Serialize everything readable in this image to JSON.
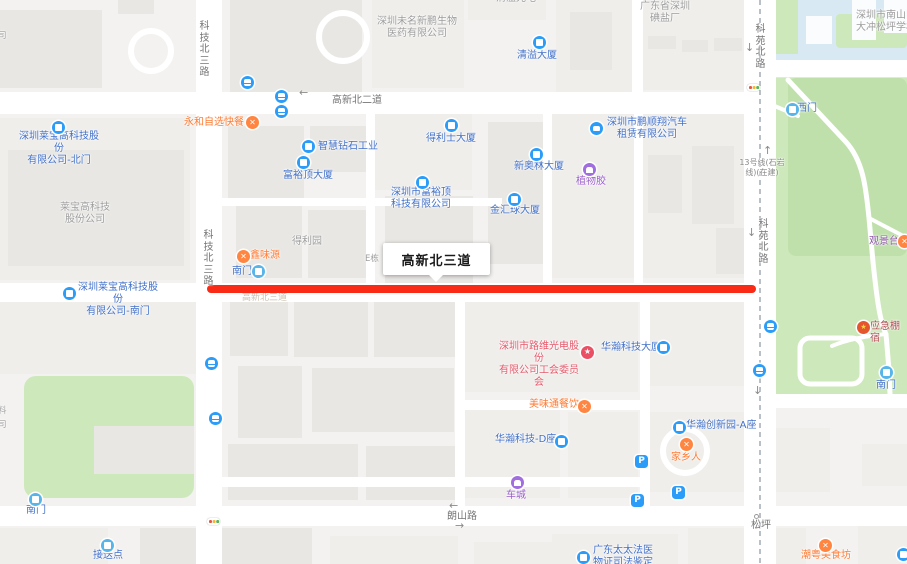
{
  "map": {
    "size": {
      "w": 907,
      "h": 564
    },
    "colors": {
      "base": "#f3f2f0",
      "building": "#e8e7e4",
      "building_light": "#efeeeb",
      "road": "#ffffff",
      "park_green": "#cde8ba",
      "park_green_dark": "#bfe0ab",
      "school_blue": "#d9e9f4",
      "highlight_red": "#fa2b16",
      "poi_blue_text": "#4170c9",
      "poi_icon_blue": "#2b9df8",
      "gate_icon_blue": "#58b5e9",
      "food_orange": "#ff7a33",
      "purple": "#9a5ecb",
      "union_red": "#e4586a",
      "emergency_red": "#b04a50",
      "scenic_purple": "#8d55a6",
      "gray_label": "#9c9c9c",
      "road_label": "#757575",
      "metro_dash": "#9aa2ac"
    },
    "callout": {
      "text": "高新北三道",
      "x": 383,
      "y": 243,
      "w": 107,
      "h": 32
    },
    "highlight": {
      "x": 207,
      "y": 285,
      "w": 549,
      "h": 8,
      "color": "#fa2b16"
    },
    "school": {
      "x": 768,
      "y": 0,
      "w": 139,
      "h": 80
    },
    "greens": [
      {
        "x": 763,
        "y": 78,
        "w": 144,
        "h": 330,
        "r": 0
      },
      {
        "x": 788,
        "y": 78,
        "w": 119,
        "h": 178,
        "r": 8,
        "shade": "dark"
      },
      {
        "x": 24,
        "y": 376,
        "w": 170,
        "h": 122,
        "r": 12
      },
      {
        "x": 772,
        "y": 0,
        "w": 26,
        "h": 54,
        "r": 0
      },
      {
        "x": 836,
        "y": 14,
        "w": 71,
        "h": 34,
        "r": 4
      }
    ],
    "white_buildings": [
      {
        "x": 852,
        "y": 0,
        "w": 24,
        "h": 40
      },
      {
        "x": 884,
        "y": 0,
        "w": 23,
        "h": 33
      },
      {
        "x": 806,
        "y": 16,
        "w": 26,
        "h": 28
      }
    ],
    "buildings": [
      {
        "x": 0,
        "y": 10,
        "w": 102,
        "h": 78
      },
      {
        "x": 118,
        "y": 0,
        "w": 36,
        "h": 14
      },
      {
        "x": 230,
        "y": 0,
        "w": 132,
        "h": 92
      },
      {
        "x": 372,
        "y": 0,
        "w": 92,
        "h": 88,
        "light": true
      },
      {
        "x": 468,
        "y": 0,
        "w": 78,
        "h": 20,
        "light": true
      },
      {
        "x": 556,
        "y": 0,
        "w": 76,
        "h": 92,
        "light": true
      },
      {
        "x": 570,
        "y": 12,
        "w": 42,
        "h": 58
      },
      {
        "x": 640,
        "y": 0,
        "w": 118,
        "h": 90,
        "light": true
      },
      {
        "x": 648,
        "y": 36,
        "w": 28,
        "h": 13
      },
      {
        "x": 682,
        "y": 40,
        "w": 26,
        "h": 12
      },
      {
        "x": 714,
        "y": 38,
        "w": 28,
        "h": 13
      },
      {
        "x": 0,
        "y": 118,
        "w": 190,
        "h": 162,
        "light": true
      },
      {
        "x": 8,
        "y": 150,
        "w": 176,
        "h": 116
      },
      {
        "x": 228,
        "y": 126,
        "w": 76,
        "h": 72
      },
      {
        "x": 310,
        "y": 126,
        "w": 56,
        "h": 46
      },
      {
        "x": 372,
        "y": 112,
        "w": 100,
        "h": 78,
        "light": true
      },
      {
        "x": 385,
        "y": 196,
        "w": 88,
        "h": 118
      },
      {
        "x": 236,
        "y": 206,
        "w": 66,
        "h": 72
      },
      {
        "x": 308,
        "y": 210,
        "w": 58,
        "h": 68
      },
      {
        "x": 488,
        "y": 122,
        "w": 58,
        "h": 142
      },
      {
        "x": 552,
        "y": 110,
        "w": 82,
        "h": 168,
        "light": true
      },
      {
        "x": 640,
        "y": 110,
        "w": 118,
        "h": 168,
        "light": true
      },
      {
        "x": 648,
        "y": 155,
        "w": 34,
        "h": 58
      },
      {
        "x": 692,
        "y": 146,
        "w": 42,
        "h": 78
      },
      {
        "x": 716,
        "y": 228,
        "w": 42,
        "h": 46
      },
      {
        "x": 0,
        "y": 302,
        "w": 196,
        "h": 72,
        "light": true
      },
      {
        "x": 94,
        "y": 426,
        "w": 100,
        "h": 48
      },
      {
        "x": 230,
        "y": 302,
        "w": 58,
        "h": 54
      },
      {
        "x": 294,
        "y": 300,
        "w": 74,
        "h": 57
      },
      {
        "x": 374,
        "y": 300,
        "w": 82,
        "h": 57
      },
      {
        "x": 238,
        "y": 366,
        "w": 64,
        "h": 72
      },
      {
        "x": 312,
        "y": 368,
        "w": 142,
        "h": 64
      },
      {
        "x": 228,
        "y": 444,
        "w": 130,
        "h": 56
      },
      {
        "x": 366,
        "y": 446,
        "w": 90,
        "h": 54
      },
      {
        "x": 462,
        "y": 298,
        "w": 176,
        "h": 94,
        "light": true
      },
      {
        "x": 646,
        "y": 300,
        "w": 112,
        "h": 86,
        "light": true
      },
      {
        "x": 462,
        "y": 410,
        "w": 98,
        "h": 88,
        "light": true
      },
      {
        "x": 568,
        "y": 412,
        "w": 70,
        "h": 86,
        "light": true
      },
      {
        "x": 648,
        "y": 412,
        "w": 110,
        "h": 80,
        "light": true
      },
      {
        "x": 772,
        "y": 428,
        "w": 58,
        "h": 64,
        "light": true
      },
      {
        "x": 862,
        "y": 444,
        "w": 45,
        "h": 42,
        "light": true
      },
      {
        "x": 0,
        "y": 528,
        "w": 108,
        "h": 36,
        "light": true
      },
      {
        "x": 140,
        "y": 528,
        "w": 172,
        "h": 36
      },
      {
        "x": 330,
        "y": 536,
        "w": 128,
        "h": 28,
        "light": true
      },
      {
        "x": 474,
        "y": 542,
        "w": 88,
        "h": 22,
        "light": true
      },
      {
        "x": 552,
        "y": 534,
        "w": 126,
        "h": 30,
        "light": true
      },
      {
        "x": 688,
        "y": 528,
        "w": 118,
        "h": 36,
        "light": true
      },
      {
        "x": 858,
        "y": 524,
        "w": 49,
        "h": 40,
        "light": true
      }
    ],
    "rings": [
      {
        "x": 128,
        "y": 28,
        "d": 46
      },
      {
        "x": 316,
        "y": 10,
        "d": 54
      },
      {
        "x": 660,
        "y": 426,
        "d": 50
      }
    ],
    "roads": [
      {
        "x": 196,
        "y": 0,
        "w": 26,
        "h": 564
      },
      {
        "x": 744,
        "y": 0,
        "w": 32,
        "h": 564
      },
      {
        "x": 0,
        "y": 92,
        "w": 748,
        "h": 22
      },
      {
        "x": 768,
        "y": 60,
        "w": 139,
        "h": 17
      },
      {
        "x": 744,
        "y": 60,
        "w": 32,
        "h": 54
      },
      {
        "x": 0,
        "y": 283,
        "w": 748,
        "h": 19
      },
      {
        "x": 0,
        "y": 506,
        "w": 907,
        "h": 20
      },
      {
        "x": 744,
        "y": 394,
        "w": 163,
        "h": 14
      },
      {
        "x": 366,
        "y": 110,
        "w": 9,
        "h": 173
      },
      {
        "x": 543,
        "y": 110,
        "w": 9,
        "h": 173
      },
      {
        "x": 634,
        "y": 110,
        "w": 9,
        "h": 173
      },
      {
        "x": 632,
        "y": 0,
        "w": 11,
        "h": 95
      },
      {
        "x": 222,
        "y": 198,
        "w": 280,
        "h": 8
      },
      {
        "x": 455,
        "y": 301,
        "w": 10,
        "h": 205
      },
      {
        "x": 640,
        "y": 301,
        "w": 10,
        "h": 205
      },
      {
        "x": 220,
        "y": 477,
        "w": 424,
        "h": 10
      },
      {
        "x": 455,
        "y": 400,
        "w": 195,
        "h": 10
      }
    ],
    "park_paths": [
      {
        "d": "M788,80 L846,142 C864,162 866,190 869,218 L873,262 C877,300 880,322 886,334 L889,370 L890,394",
        "w": 5
      },
      {
        "d": "M869,218 C884,226 896,232 907,238",
        "w": 4
      },
      {
        "d": "M886,334 C866,336 846,340 832,346",
        "w": 4
      },
      {
        "d": "M770,104 L798,116",
        "w": 4
      }
    ],
    "park_loop": {
      "x": 800,
      "y": 338,
      "w": 62,
      "h": 46,
      "r": 10,
      "stroke": 5
    },
    "metro_line": {
      "x": 760,
      "dash": "5 4",
      "color": "#9aa2ac"
    },
    "labels": [
      {
        "t": "清溢光电",
        "x": 496,
        "y": -7,
        "cls": "area"
      },
      {
        "t": "深圳未名新鹏生物\n医药有限公司",
        "x": 374,
        "y": 16,
        "w": 86,
        "cls": "area"
      },
      {
        "t": "广东省深圳\n碘盐厂",
        "x": 634,
        "y": 1,
        "w": 62,
        "cls": "area"
      },
      {
        "t": "深圳市南山区\n大冲松坪学校",
        "x": 851,
        "y": 10,
        "w": 70,
        "cls": "area"
      },
      {
        "t": "司",
        "x": -2,
        "y": 31,
        "cls": "area-sm"
      },
      {
        "t": "科技北三路",
        "x": 198,
        "y": 21,
        "cls": "roadlbl",
        "v": true
      },
      {
        "t": "高新北二道",
        "x": 332,
        "y": 95,
        "cls": "roadlbl"
      },
      {
        "t": "科苑北路",
        "x": 754,
        "y": 24,
        "cls": "roadlbl",
        "v": true
      },
      {
        "t": "清溢大厦",
        "x": 517,
        "y": 50,
        "cls": "poi"
      },
      {
        "t": "永和自选快餐",
        "x": 184,
        "y": 117,
        "cls": "food"
      },
      {
        "t": "深圳市鹏顺翔汽车\n租赁有限公司",
        "x": 604,
        "y": 117,
        "w": 86,
        "cls": "poi"
      },
      {
        "t": "西门",
        "x": 797,
        "y": 103,
        "cls": "poi"
      },
      {
        "t": "智慧钻石工业",
        "x": 318,
        "y": 141,
        "cls": "poi"
      },
      {
        "t": "得利士大厦",
        "x": 426,
        "y": 133,
        "cls": "poi"
      },
      {
        "t": "富裕顶大厦",
        "x": 283,
        "y": 170,
        "cls": "poi"
      },
      {
        "t": "新奥林大厦",
        "x": 514,
        "y": 161,
        "cls": "poi"
      },
      {
        "t": "深圳市富裕顶\n科技有限公司",
        "x": 391,
        "y": 187,
        "w": 60,
        "cls": "poi"
      },
      {
        "t": "金汇球大厦",
        "x": 490,
        "y": 205,
        "cls": "poi"
      },
      {
        "t": "植物胶",
        "x": 576,
        "y": 176,
        "cls": "purple"
      },
      {
        "t": "13号线(石岩\n线)(在建)",
        "x": 739,
        "y": 158,
        "w": 46,
        "cls": "road-sm"
      },
      {
        "t": "科苑北路",
        "x": 757,
        "y": 219,
        "cls": "roadlbl",
        "v": true
      },
      {
        "t": "观景台",
        "x": 869,
        "y": 236,
        "cls": "scenic"
      },
      {
        "t": "莱宝高科技\n股份公司",
        "x": 55,
        "y": 202,
        "w": 60,
        "cls": "area"
      },
      {
        "t": "深圳莱宝高科技股份\n有限公司-北门",
        "x": 16,
        "y": 131,
        "w": 86,
        "cls": "poi"
      },
      {
        "t": "科技北三路",
        "x": 202,
        "y": 230,
        "cls": "roadlbl",
        "v": true
      },
      {
        "t": "鑫味源",
        "x": 250,
        "y": 250,
        "cls": "food"
      },
      {
        "t": "得利园",
        "x": 292,
        "y": 236,
        "cls": "area"
      },
      {
        "t": "E栋",
        "x": 365,
        "y": 254,
        "cls": "area-sm"
      },
      {
        "t": "南门",
        "x": 232,
        "y": 266,
        "cls": "poi"
      },
      {
        "t": "深圳莱宝高科技股份\n有限公司-南门",
        "x": 75,
        "y": 282,
        "w": 86,
        "cls": "poi"
      },
      {
        "t": "高新北三道",
        "x": 242,
        "y": 292,
        "cls": "faint"
      },
      {
        "t": "深圳市路维光电股份\n有限公司工会委员会",
        "x": 497,
        "y": 341,
        "w": 84,
        "cls": "union"
      },
      {
        "t": "华瀚科技大厦",
        "x": 601,
        "y": 342,
        "cls": "poi"
      },
      {
        "t": "应急棚宿",
        "x": 870,
        "y": 321,
        "cls": "emerg"
      },
      {
        "t": "南门",
        "x": 876,
        "y": 380,
        "cls": "poi"
      },
      {
        "t": "料",
        "x": -2,
        "y": 406,
        "cls": "area-sm"
      },
      {
        "t": "司",
        "x": -2,
        "y": 420,
        "cls": "area-sm"
      },
      {
        "t": "美味通餐饮",
        "x": 529,
        "y": 399,
        "cls": "food"
      },
      {
        "t": "华瀚创新园-A座",
        "x": 686,
        "y": 420,
        "cls": "poi"
      },
      {
        "t": "家乡人",
        "x": 671,
        "y": 452,
        "cls": "food"
      },
      {
        "t": "华瀚科技-D座",
        "x": 495,
        "y": 434,
        "cls": "poi"
      },
      {
        "t": "车城",
        "x": 506,
        "y": 490,
        "cls": "purple"
      },
      {
        "t": "南门",
        "x": 26,
        "y": 505,
        "cls": "poi"
      },
      {
        "t": "朗山路",
        "x": 447,
        "y": 511,
        "cls": "roadlbl"
      },
      {
        "t": "松坪",
        "x": 751,
        "y": 520,
        "cls": "roadlbl"
      },
      {
        "t": "接送点",
        "x": 93,
        "y": 550,
        "cls": "poi"
      },
      {
        "t": "广东太太法医\n物证司法鉴定所",
        "x": 590,
        "y": 545,
        "w": 66,
        "cls": "poi"
      },
      {
        "t": "潮粤美食坊",
        "x": 801,
        "y": 550,
        "cls": "food"
      }
    ],
    "icons": [
      {
        "t": "bus",
        "x": 241,
        "y": 76
      },
      {
        "t": "bus",
        "x": 275,
        "y": 90
      },
      {
        "t": "bus",
        "x": 275,
        "y": 105
      },
      {
        "t": "bus",
        "x": 205,
        "y": 357
      },
      {
        "t": "bus",
        "x": 209,
        "y": 412
      },
      {
        "t": "bus",
        "x": 764,
        "y": 320
      },
      {
        "t": "bus",
        "x": 753,
        "y": 364
      },
      {
        "t": "tl",
        "x": 747,
        "y": 84
      },
      {
        "t": "tl",
        "x": 207,
        "y": 518
      },
      {
        "t": "gate",
        "x": 252,
        "y": 265
      },
      {
        "t": "gate",
        "x": 786,
        "y": 103
      },
      {
        "t": "gate",
        "x": 29,
        "y": 493
      },
      {
        "t": "gate",
        "x": 880,
        "y": 366
      },
      {
        "t": "gate",
        "x": 101,
        "y": 539
      },
      {
        "t": "bld",
        "x": 533,
        "y": 36
      },
      {
        "t": "bld",
        "x": 445,
        "y": 119
      },
      {
        "t": "bld",
        "x": 302,
        "y": 140
      },
      {
        "t": "bld",
        "x": 297,
        "y": 156
      },
      {
        "t": "bld",
        "x": 530,
        "y": 148
      },
      {
        "t": "bld",
        "x": 416,
        "y": 176
      },
      {
        "t": "bld",
        "x": 508,
        "y": 193
      },
      {
        "t": "bld",
        "x": 657,
        "y": 341
      },
      {
        "t": "bld",
        "x": 673,
        "y": 421
      },
      {
        "t": "bld",
        "x": 555,
        "y": 435
      },
      {
        "t": "bld",
        "x": 577,
        "y": 551
      },
      {
        "t": "bld",
        "x": 897,
        "y": 548
      },
      {
        "t": "bld",
        "x": 52,
        "y": 121
      },
      {
        "t": "bld",
        "x": 63,
        "y": 287
      },
      {
        "t": "car",
        "x": 590,
        "y": 122
      },
      {
        "t": "food",
        "x": 246,
        "y": 116
      },
      {
        "t": "food",
        "x": 237,
        "y": 250
      },
      {
        "t": "food",
        "x": 578,
        "y": 400
      },
      {
        "t": "food",
        "x": 680,
        "y": 438
      },
      {
        "t": "food",
        "x": 819,
        "y": 539
      },
      {
        "t": "food",
        "x": 898,
        "y": 235
      },
      {
        "t": "bag",
        "x": 583,
        "y": 163
      },
      {
        "t": "bag",
        "x": 511,
        "y": 476
      },
      {
        "t": "star",
        "x": 581,
        "y": 346
      },
      {
        "t": "emblem",
        "x": 857,
        "y": 321
      },
      {
        "t": "p",
        "x": 635,
        "y": 455
      },
      {
        "t": "p",
        "x": 672,
        "y": 486
      },
      {
        "t": "p",
        "x": 631,
        "y": 494
      }
    ],
    "arrows": [
      {
        "g": "←",
        "x": 299,
        "y": 87
      },
      {
        "g": "↓",
        "x": 745,
        "y": 42
      },
      {
        "g": "↑",
        "x": 763,
        "y": 145
      },
      {
        "g": "↓",
        "x": 747,
        "y": 227
      },
      {
        "g": "↓",
        "x": 753,
        "y": 385
      },
      {
        "g": "←",
        "x": 449,
        "y": 500
      },
      {
        "g": "→",
        "x": 455,
        "y": 520
      }
    ],
    "junction_dot": {
      "x": 754,
      "y": 514
    }
  }
}
